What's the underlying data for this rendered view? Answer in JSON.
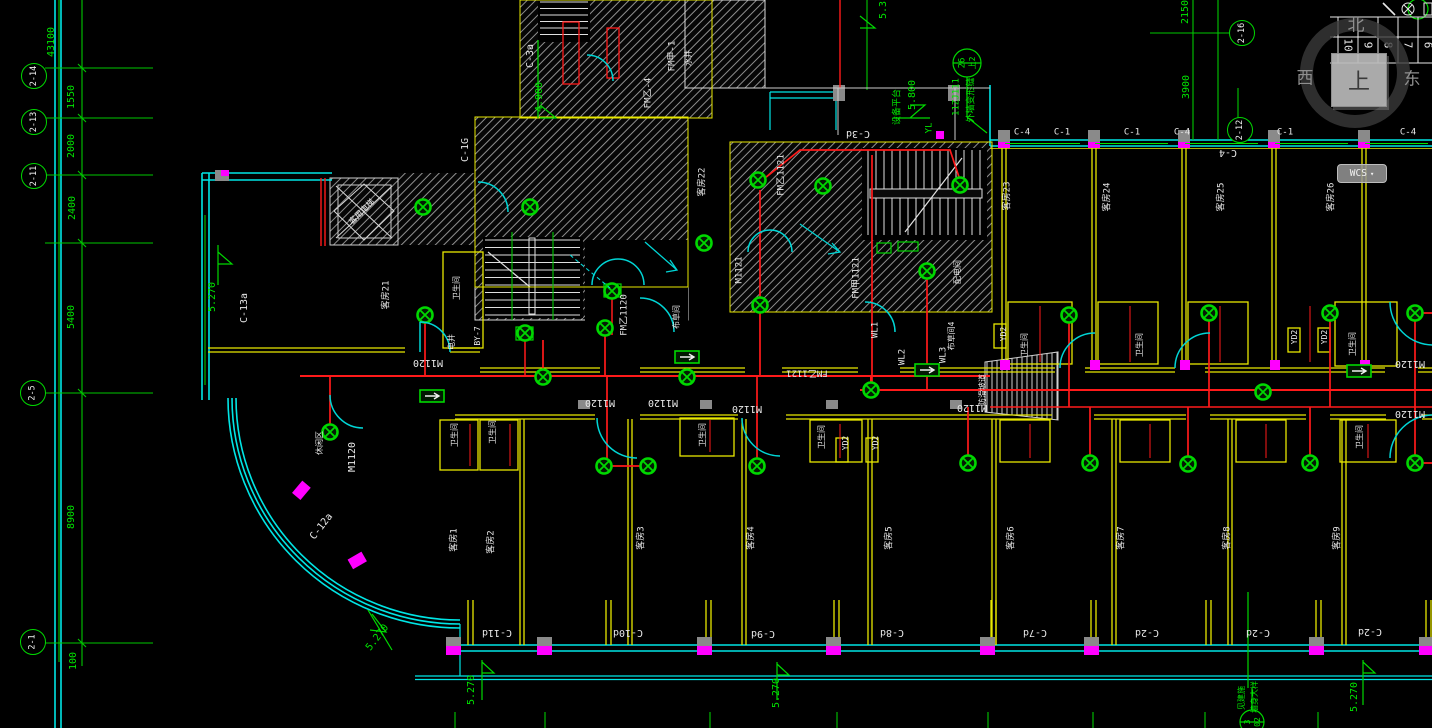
{
  "colors": {
    "grid": "#00e600",
    "wall": "#00ffff",
    "partition": "#ffff00",
    "wiring": "#ff1a1a",
    "column": "#ff00ff",
    "hatch": "#8a8a8a",
    "text": "#e8e8e8",
    "background": "#000000"
  },
  "grid": {
    "left_dims": [
      "43100",
      "1550",
      "2000",
      "2400",
      "5400",
      "8900",
      "100"
    ],
    "left_bubbles": [
      "2-14",
      "2-13",
      "2-11",
      "2-5",
      "2-1"
    ],
    "right_dims": [
      "2150",
      "3900"
    ],
    "right_bubbles": [
      "2-16",
      "2-12"
    ]
  },
  "elevations": {
    "e53": "5.3",
    "e4900": "4.900",
    "e5800": "5.800",
    "e5270": "5.270",
    "platform": "设备平台"
  },
  "rooms": {
    "g1": "客房1",
    "g2": "客房2",
    "g3": "客房3",
    "g4": "客房4",
    "g5": "客房5",
    "g6": "客房6",
    "g7": "客房7",
    "g8": "客房8",
    "g9": "客房9",
    "g21": "客房21",
    "g22": "客房22",
    "g23": "客房23",
    "g24": "客房24",
    "g25": "客房25",
    "g26": "客房26",
    "bathroom": "卫生间",
    "linen4": "布草间4",
    "linen": "布草间",
    "leisure": "休闲区",
    "elec": "配电间",
    "shaft": "水井",
    "elevator": "客用电梯",
    "ramp": "防滑坡道"
  },
  "doors": {
    "m1120": "M1120",
    "m1121": "M1121",
    "fmy1121": "FM乙1121",
    "fmj1121": "FM甲1121",
    "fmy1120": "FM乙1120",
    "fmy4": "FM乙-4",
    "fmj1": "FM甲-1"
  },
  "windows": {
    "c1": "C-1",
    "c4": "C-4",
    "c3a": "C-3a",
    "c3d": "C-3d",
    "c1g": "C-1G",
    "c13a": "C-13a",
    "c12a": "C-12a",
    "c11d": "C-11d",
    "c10d": "C-10d",
    "c9d": "C-9d",
    "c8d": "C-8d",
    "c7d": "C-7d",
    "c2d": "C-2d"
  },
  "circuits": {
    "wl1": "WL1",
    "wl2": "WL2",
    "wl3": "WL3",
    "yd2": "YD2",
    "yl": "YL",
    "by7": "BY-7",
    "dj": "电井"
  },
  "callouts": {
    "joint_ref": "11ZJ111",
    "joint": "外墙变形缝",
    "d1_top": "26",
    "d1_bot": "上2",
    "d2_top": "3",
    "d2_bot": "02",
    "see_arch": "见建施",
    "wall_detail": "墙身大样"
  },
  "viewcube": {
    "north": "北",
    "west": "西",
    "east": "东",
    "top": "上",
    "wcs": "WCS",
    "caret": "▾"
  },
  "border_table": {
    "numbers": [
      "10",
      "9",
      "8",
      "7",
      "6"
    ]
  }
}
